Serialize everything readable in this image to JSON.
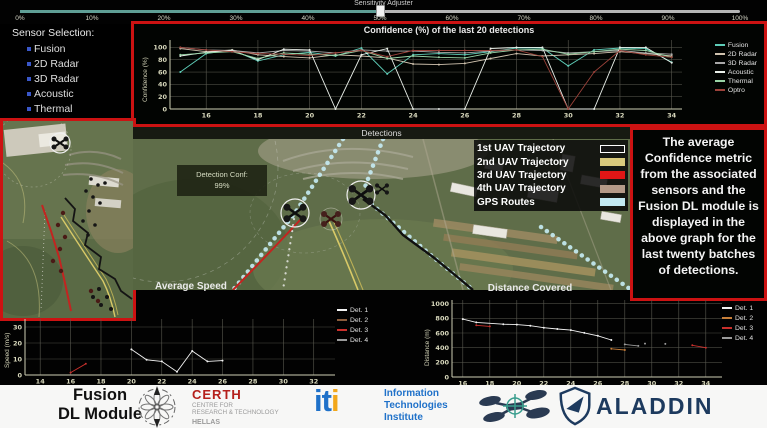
{
  "app": {
    "accent_red": "#cc1212",
    "background": "#020202"
  },
  "slider": {
    "label": "Sensitivity Adjuster",
    "value_percent": 50,
    "tick_labels": [
      "0%",
      "10%",
      "20%",
      "30%",
      "40%",
      "50%",
      "60%",
      "70%",
      "80%",
      "90%",
      "100%"
    ],
    "track_color_left": "#5f9e95",
    "track_color_right": "#b5b5b5"
  },
  "sensor_panel": {
    "title": "Sensor Selection:",
    "bullet_color": "#3a57c9",
    "items": [
      {
        "label": "Fusion"
      },
      {
        "label": "2D Radar"
      },
      {
        "label": "3D Radar"
      },
      {
        "label": "Acoustic"
      },
      {
        "label": "Thermal"
      },
      {
        "label": "Optro"
      }
    ]
  },
  "map": {
    "title": "Detections",
    "detection_box": {
      "label": "Detection Conf:",
      "value": "99%"
    },
    "legend": [
      {
        "label": "1st UAV Trajectory",
        "color": "#161616",
        "border": "#ffffff"
      },
      {
        "label": "2nd UAV Trajectory",
        "color": "#d9ca7c",
        "border": "#d9ca7c"
      },
      {
        "label": "3rd UAV Trajectory",
        "color": "#e01616",
        "border": "#e01616"
      },
      {
        "label": "4th UAV Trajectory",
        "color": "#b49a88",
        "border": "#b49a88"
      },
      {
        "label": "GPS Routes",
        "color": "#c2e9f2",
        "border": "#c2e9f2"
      }
    ]
  },
  "info_box": {
    "text": "The average Confidence metric from the associated sensors and the Fusion DL module is displayed in the above graph for the last twenty batches of detections."
  },
  "chart_data": [
    {
      "type": "line",
      "title": "Confidence (%) of the last 20 detections",
      "ylabel": "Confidence (%)",
      "x": [
        15,
        16,
        17,
        18,
        19,
        20,
        21,
        22,
        23,
        24,
        25,
        26,
        27,
        28,
        29,
        30,
        31,
        32,
        33,
        34
      ],
      "xticks": [
        16,
        18,
        20,
        22,
        24,
        26,
        28,
        30,
        32,
        34
      ],
      "ylim": [
        0,
        112
      ],
      "yticks": [
        0,
        20,
        40,
        60,
        80,
        100
      ],
      "grid": true,
      "legend_position": "right",
      "series": [
        {
          "name": "Fusion",
          "color": "#5ecdb8",
          "values": [
            60,
            90,
            96,
            78,
            88,
            92,
            86,
            99,
            57,
            88,
            90,
            88,
            93,
            99,
            99,
            70,
            96,
            99,
            98,
            76
          ]
        },
        {
          "name": "2D Radar",
          "color": "#cfc2ae",
          "values": [
            98,
            93,
            96,
            88,
            85,
            83,
            88,
            86,
            83,
            73,
            72,
            74,
            82,
            90,
            86,
            88,
            90,
            93,
            90,
            86
          ]
        },
        {
          "name": "3D Radar",
          "color": "#a9a9a9",
          "values": [
            100,
            96,
            95,
            91,
            95,
            94,
            91,
            96,
            94,
            94,
            92,
            91,
            94,
            96,
            95,
            91,
            93,
            95,
            91,
            89
          ]
        },
        {
          "name": "Acoustic",
          "color": "#e9efe9",
          "values": [
            86,
            92,
            95,
            80,
            97,
            96,
            0,
            88,
            98,
            0,
            0,
            0,
            98,
            100,
            100,
            0,
            0,
            100,
            100,
            75
          ]
        },
        {
          "name": "Thermal",
          "color": "#99d4a6",
          "values": [
            88,
            91,
            93,
            82,
            91,
            89,
            87,
            95,
            82,
            86,
            84,
            83,
            91,
            96,
            97,
            89,
            93,
            97,
            95,
            84
          ]
        },
        {
          "name": "Optro",
          "color": "#9c423a",
          "values": [
            100,
            96,
            93,
            90,
            89,
            87,
            91,
            95,
            85,
            95,
            95,
            95,
            95,
            96,
            85,
            0,
            60,
            95,
            88,
            84
          ]
        }
      ]
    },
    {
      "type": "line",
      "title": "Average Speed",
      "ylabel": "Speed (m/s)",
      "xlim": [
        13,
        33.4
      ],
      "xticks": [
        14,
        16,
        18,
        20,
        22,
        24,
        26,
        28,
        30,
        32
      ],
      "ylim": [
        0,
        35
      ],
      "yticks": [
        0,
        10,
        20,
        30
      ],
      "grid": true,
      "legend_position": "right",
      "series": [
        {
          "name": "Det. 1",
          "color": "#f2f2f2",
          "points": [
            [
              20,
              16
            ],
            [
              21,
              9.5
            ],
            [
              22,
              8.5
            ],
            [
              23,
              2
            ],
            [
              24,
              15
            ],
            [
              25,
              8.5
            ],
            [
              26,
              9
            ]
          ]
        },
        {
          "name": "Det. 2",
          "color": "#8a5c3c",
          "points": []
        },
        {
          "name": "Det. 3",
          "color": "#c9302c",
          "points": [
            [
              16,
              1.5
            ],
            [
              17,
              7
            ]
          ]
        },
        {
          "name": "Det. 4",
          "color": "#9a9a9a",
          "points": []
        }
      ]
    },
    {
      "type": "line",
      "title": "Distance Covered",
      "ylabel": "Distance (m)",
      "xlim": [
        15.2,
        35.2
      ],
      "xticks": [
        16,
        18,
        20,
        22,
        24,
        26,
        28,
        30,
        32,
        34
      ],
      "ylim": [
        0,
        1050
      ],
      "yticks": [
        0,
        200,
        400,
        600,
        800,
        1000
      ],
      "grid": true,
      "legend_position": "right",
      "series": [
        {
          "name": "Det. 1",
          "color": "#f2f2f2",
          "points": [
            [
              16,
              790
            ],
            [
              17,
              745
            ],
            [
              19,
              720
            ],
            [
              20,
              715
            ],
            [
              21,
              700
            ],
            [
              22,
              672
            ],
            [
              23,
              655
            ],
            [
              24,
              640
            ],
            [
              25,
              602
            ],
            [
              26,
              562
            ],
            [
              27,
              505
            ]
          ]
        },
        {
          "name": "Det. 2",
          "color": "#c87f3a",
          "points": [
            [
              27,
              385
            ],
            [
              28,
              368
            ]
          ]
        },
        {
          "name": "Det. 3",
          "color": "#c9302c",
          "points": [
            [
              17,
              705
            ],
            [
              18,
              690
            ],
            null,
            [
              33,
              432
            ],
            [
              34,
              400
            ]
          ]
        },
        {
          "name": "Det. 4",
          "color": "#9a9a9a",
          "points": [
            [
              28,
              445
            ],
            [
              29,
              424
            ],
            null,
            [
              29.5,
              455
            ],
            null,
            [
              31,
              452
            ]
          ]
        }
      ]
    }
  ],
  "footer": {
    "module_line1": "Fusion",
    "module_line2": "DL Module",
    "certh": {
      "name": "CERTH",
      "sub1": "CENTRE FOR",
      "sub2": "RESEARCH & TECHNOLOGY",
      "sub3": "HELLAS",
      "name_color": "#b5201c",
      "sub_color": "#9a9a9a"
    },
    "iti": {
      "logo_i1": "i",
      "logo_t": "t",
      "logo_i2": "i",
      "line1": "Information",
      "line2": "Technologies",
      "line3": "Institute",
      "blue": "#1f71c9",
      "orange": "#f2a71b"
    },
    "aladdin": {
      "name": "ALADDIN",
      "color": "#1d3a5e"
    }
  }
}
